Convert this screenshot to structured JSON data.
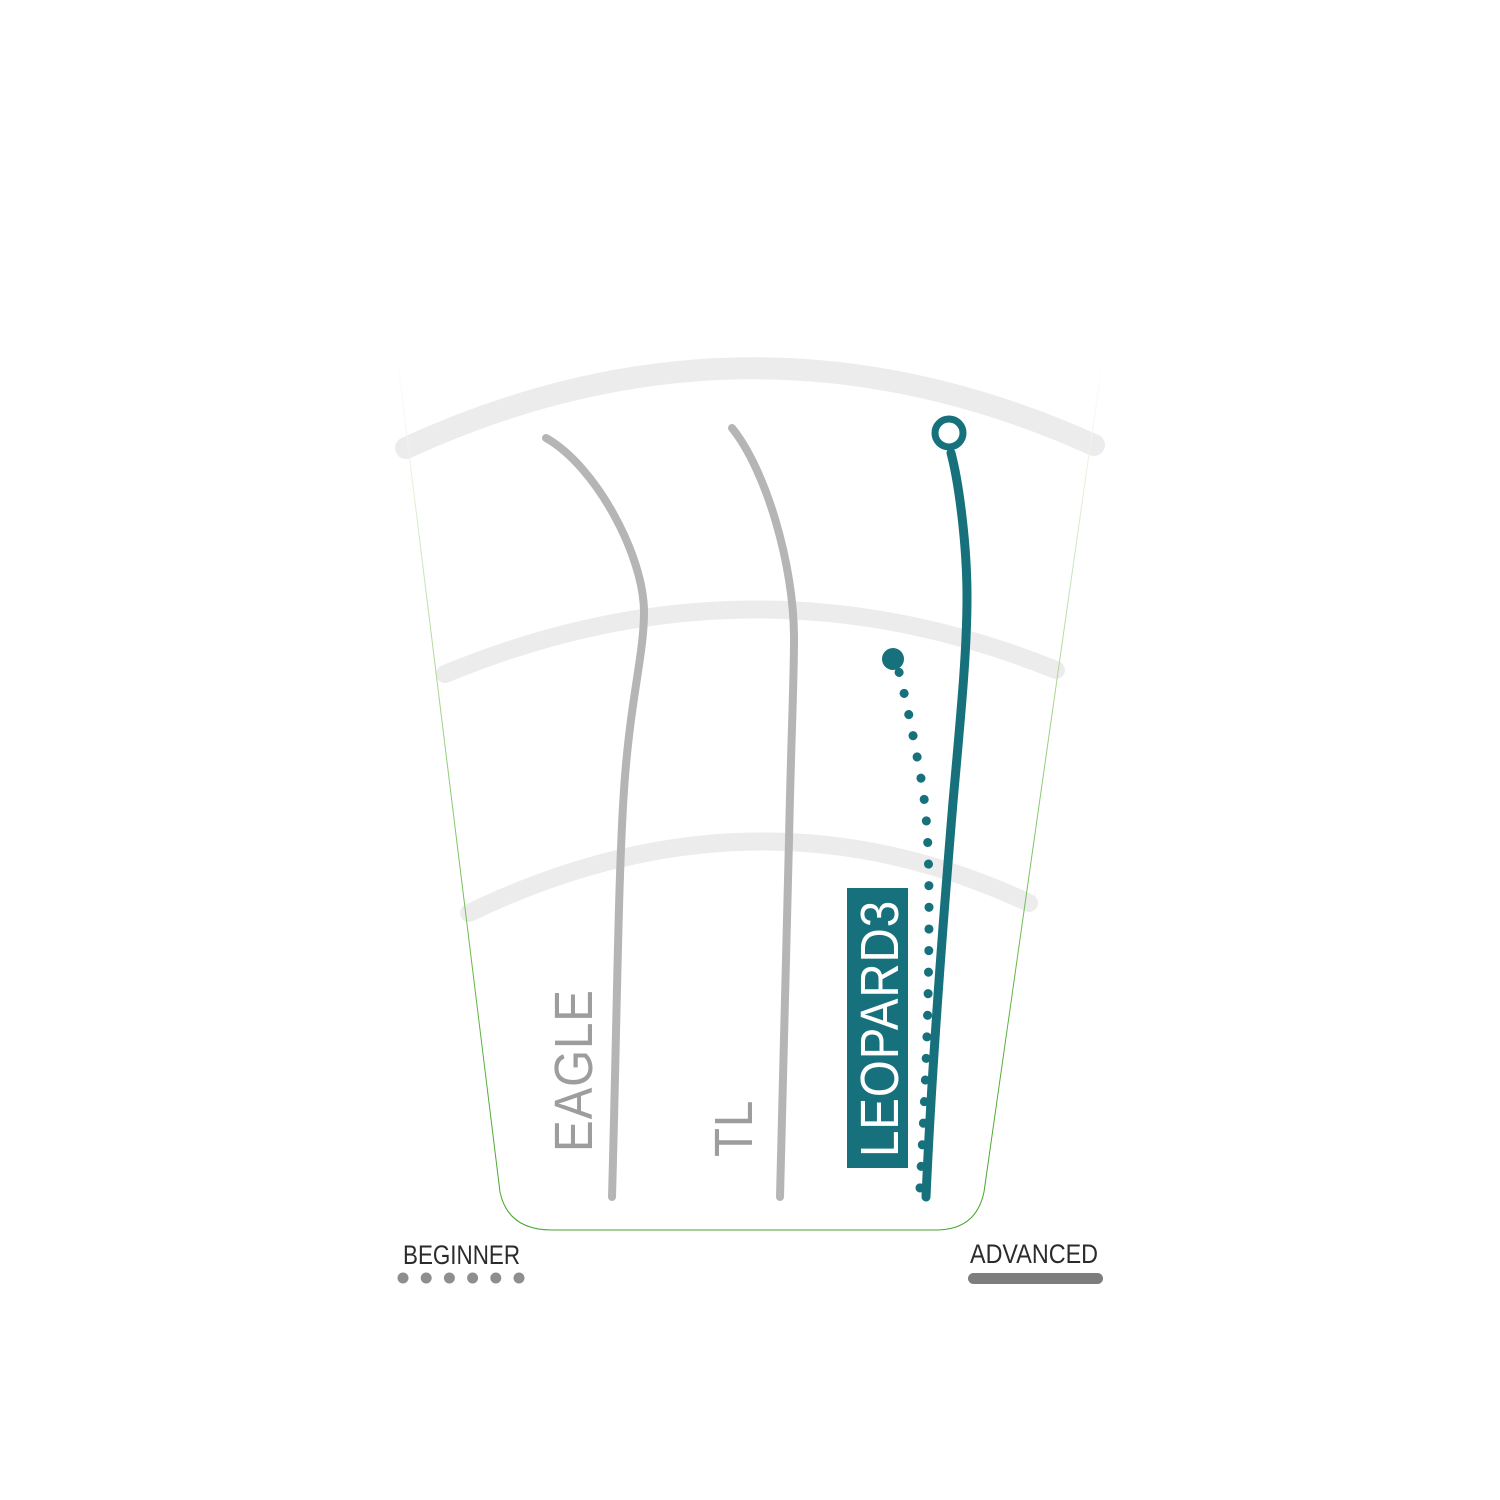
{
  "title": "Disc flight path comparison chart",
  "colors": {
    "green": "#4cae31",
    "teal": "#16717c",
    "gray_line": "#b5b5b5",
    "arc_gray": "#ececec",
    "label_gray": "#9d9d9d",
    "text_dark": "#2b2b2b",
    "dot_gray": "#8e8e8e",
    "bar_gray": "#7d7d7d",
    "white": "#ffffff"
  },
  "discs": {
    "eagle": "EAGLE",
    "tl": "TL",
    "leopard3": "LEOPARD3"
  },
  "legend": {
    "beginner": "BEGINNER",
    "advanced": "ADVANCED"
  },
  "chart_data": {
    "type": "line",
    "subtype": "disc-golf-flight-path-comparison",
    "title": "",
    "x_axis": {
      "label_left": "BEGINNER",
      "label_right": "ADVANCED",
      "indicator_left": "dotted",
      "indicator_right": "solid"
    },
    "distance_rings_count": 3,
    "series": [
      {
        "name": "EAGLE",
        "line_style": "solid",
        "color": "#b5b5b5",
        "highlighted": false,
        "end_marker": "none",
        "path_points_px": [
          [
            612,
            1197
          ],
          [
            624,
            790
          ],
          [
            644,
            612
          ],
          [
            546,
            438
          ]
        ]
      },
      {
        "name": "TL",
        "line_style": "solid",
        "color": "#b5b5b5",
        "highlighted": false,
        "end_marker": "none",
        "path_points_px": [
          [
            780,
            1197
          ],
          [
            789,
            840
          ],
          [
            794,
            638
          ],
          [
            732,
            428
          ]
        ]
      },
      {
        "name": "LEOPARD3",
        "line_style": "solid",
        "color": "#16717c",
        "highlighted": true,
        "end_marker": "open-circle",
        "path_points_px": [
          [
            926,
            1197
          ],
          [
            953,
            802
          ],
          [
            967,
            597
          ],
          [
            951,
            453
          ]
        ]
      },
      {
        "name": "LEOPARD3",
        "line_style": "dotted",
        "color": "#16717c",
        "highlighted": true,
        "end_marker": "filled-dot",
        "path_points_px": [
          [
            920,
            1188
          ],
          [
            929,
            910
          ],
          [
            923,
            790
          ],
          [
            899,
            672
          ]
        ]
      }
    ],
    "render": {
      "outline_d": "M 397,356 L 500,1192 Q 508,1230 552,1230 L 936,1230 Q 976,1230 984,1192 L 1103,356",
      "outline_width": 8,
      "gradient_stops": [
        {
          "offset": "0%",
          "color": "#ffffff"
        },
        {
          "offset": "12%",
          "color": "#e9f4e3"
        },
        {
          "offset": "30%",
          "color": "#bbdda8"
        },
        {
          "offset": "50%",
          "color": "#8cc972"
        },
        {
          "offset": "72%",
          "color": "#60b642"
        },
        {
          "offset": "100%",
          "color": "#44a52a"
        }
      ],
      "arc_color": "#ececec",
      "arcs": [
        {
          "d": "M 406,448 Q 750,290 1094,445",
          "width": 22
        },
        {
          "d": "M 445,674 Q 752,547 1056,670",
          "width": 18
        },
        {
          "d": "M 469,913 Q 755,775 1029,903",
          "width": 18
        }
      ],
      "flight_paths": [
        {
          "name": "flight-path-eagle",
          "d": "M 612,1197 C 617,1020 618,880 624,790 C 630,700 644,655 644,612 C 644,556 596,466 546,438",
          "color": "#b5b5b5",
          "width": 8
        },
        {
          "name": "flight-path-tl",
          "d": "M 780,1197 C 784,1060 787,940 789,840 C 791,740 794,685 794,638 C 794,565 766,470 732,428",
          "color": "#b5b5b5",
          "width": 8
        },
        {
          "name": "flight-path-leopard3",
          "d": "M 926,1197 C 932,1060 944,910 953,802 C 961,712 967,652 967,597 C 967,545 959,483 951,453",
          "color": "#16717c",
          "width": 9
        },
        {
          "name": "flight-path-leopard3-dotted",
          "d": "M 920,1188 C 926,1080 929,1000 929,910 C 929,848 927,820 923,790 C 917,755 909,712 899,672",
          "color": "#16717c",
          "width": 9,
          "dash": "0.1 21.5"
        }
      ],
      "markers": [
        {
          "name": "leopard3-end-marker",
          "type": "ring",
          "cx": 949,
          "cy": 433,
          "r": 14,
          "stroke": 7
        },
        {
          "name": "leopard3-dotted-end-marker",
          "type": "dot",
          "cx": 893,
          "cy": 659,
          "r": 11
        }
      ],
      "beginner_dots": {
        "count": 6,
        "cx0": 403,
        "dx": 23.2,
        "cy": 1278,
        "r": 5.5
      },
      "advanced_bar": {
        "x": 968,
        "y": 1273,
        "width": 135,
        "height": 11,
        "rx": 5.5
      }
    }
  }
}
